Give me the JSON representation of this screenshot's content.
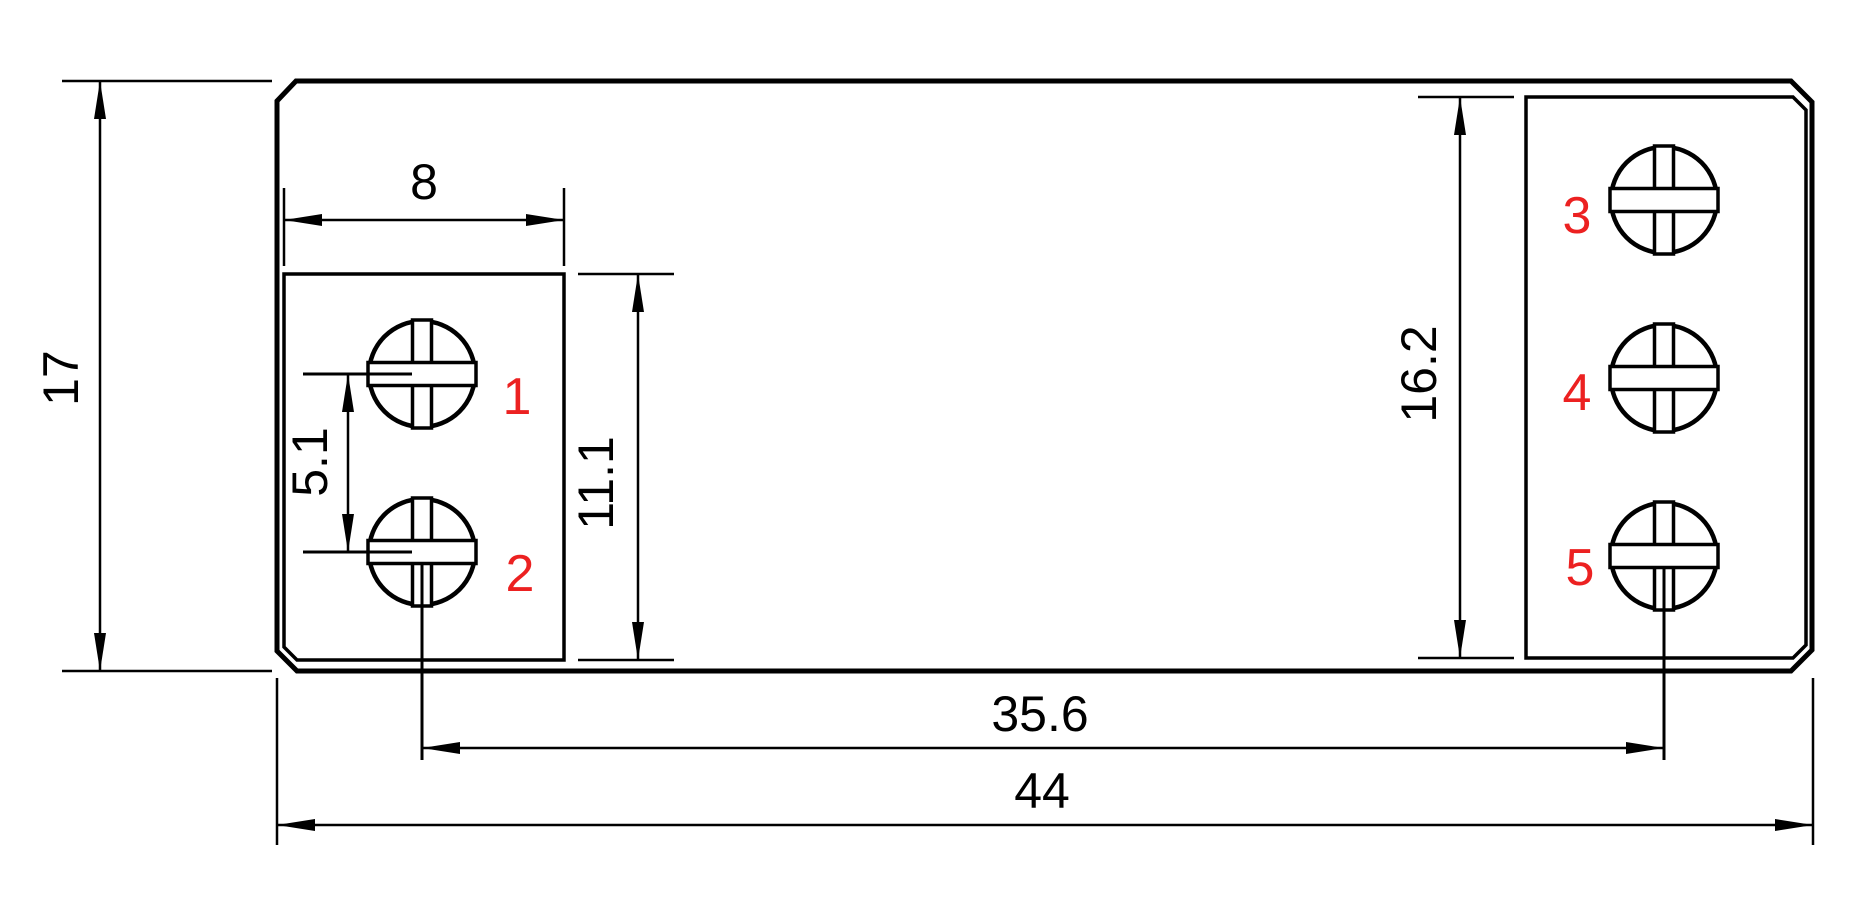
{
  "drawing": {
    "kind": "technical-dimension-drawing",
    "part": "terminal-block-footprint",
    "dimensions": {
      "overall_height": "17",
      "left_block_width": "8",
      "screw_pitch": "5.1",
      "left_block_height": "11.1",
      "right_block_height": "16.2",
      "screw_center_span": "35.6",
      "overall_width": "44"
    },
    "terminals": [
      "1",
      "2",
      "3",
      "4",
      "5"
    ],
    "colors": {
      "line": "#000000",
      "terminal_label": "#ec2121",
      "background": "#ffffff"
    }
  }
}
